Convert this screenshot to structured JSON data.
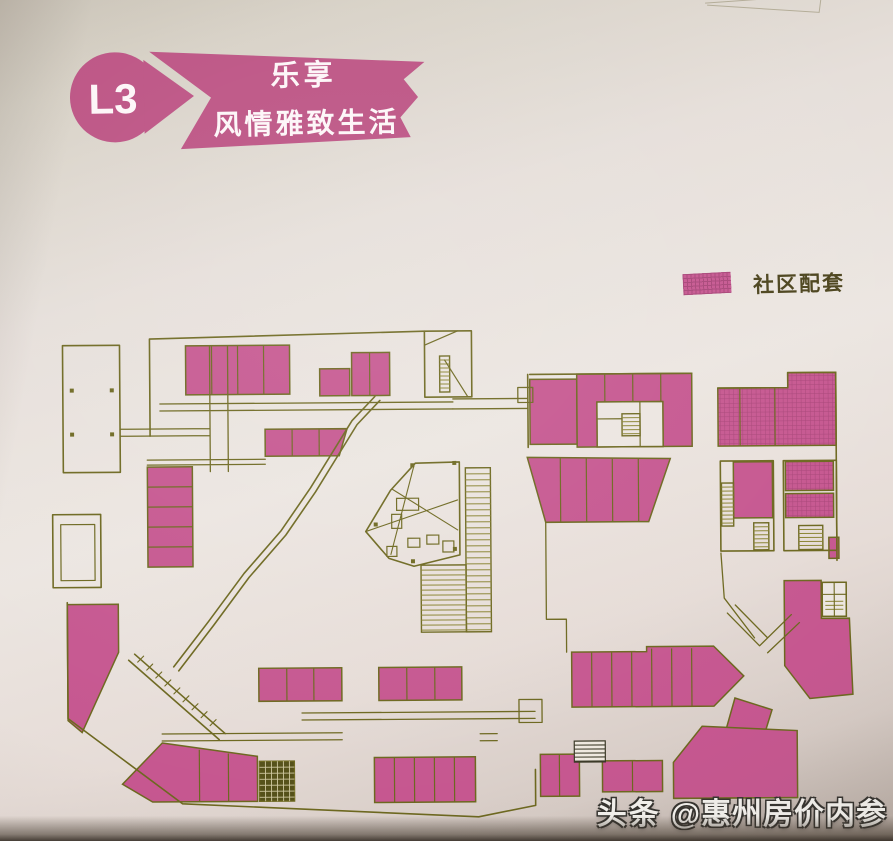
{
  "banner": {
    "level": "L3",
    "tagline_top": "乐享",
    "tagline_bottom": "风情雅致生活"
  },
  "legend": {
    "label": "社区配套"
  },
  "watermark": {
    "brand": "头条",
    "handle": "@惠州房价内参"
  },
  "colors": {
    "banner_pink": "#bc5283",
    "block_pink": "#c65790",
    "block_pink_grid": "#a84578",
    "line_olive": "#6d6820",
    "hatch_olive": "#8a8433",
    "dark_olive": "#55511a",
    "dark_olive_grid": "#cfc8a0",
    "text_olive": "#4b431c",
    "paper": "#ece6e1",
    "stroke_faint": "#b3ac97",
    "watermark_white": "#f3f1ed"
  },
  "floorplan": {
    "paths": [
      {
        "d": "M63,343 H120 V470 H63 Z"
      },
      {
        "d": "M52,512 H100 V585 H52 Z"
      },
      {
        "d": "M60,522 H94 V578 H60 Z",
        "w": 1.2
      },
      {
        "d": "M150,337 L425,331 M150,337 V434"
      },
      {
        "d": "M425,331 H472 V397 H425 Z"
      },
      {
        "d": "M425,345 L458,331 M468,397 L445,360",
        "w": 1.2
      },
      {
        "d": "M210,345 V470 M228,345 V470 M120,427 H210 M120,434 H210 M160,402 H453 M160,409 H453 M147,458 H265 M147,463 H265",
        "w": 1.3
      },
      {
        "d": "M66,600 V716 L180,802 L476,817 L533,806 V770"
      },
      {
        "d": "M160,732 H340 M160,739 H340 M300,712 H533 M300,719 H533",
        "w": 1.3
      },
      {
        "d": "M375,396 L352,420 L310,487 L280,530 L243,572 L207,620 L172,665 M380,400 L357,424 L315,491 L285,534 L248,576 L212,624 L177,669"
      },
      {
        "d": "M127,658 L217,738 M133,652 L223,732"
      },
      {
        "d": "M136,660 L142,654 M145,668 L151,662 M154,676 L160,670 M163,684 L169,678 M172,692 L178,686 M181,700 L187,694 M190,708 L196,702 M199,716 L205,710 M208,724 L214,718",
        "w": 1.1
      },
      {
        "d": "M453,399 H528 M453,409 H528 M518,388 H533 V403 H518 Z",
        "w": 1.3
      },
      {
        "d": "M530,375 H692 M718,390 H788 V375 H836 V563 M528,375 V448"
      },
      {
        "d": "M597,403 H663 V448 H597 Z M597,420 H622 M640,403 V448",
        "w": 1.2
      },
      {
        "d": "M545,523 V578 M545,578 V620 H565 V653",
        "w": 1.3
      },
      {
        "d": "M720,463 H773 V553 H720 Z"
      },
      {
        "d": "M783,463 H836 V553 H783 Z"
      },
      {
        "d": "M726,615 L758,648 M734,607 L766,640 M758,648 L790,617 M766,655 L798,625 M720,555 L723,600 L753,640",
        "w": 1.3
      },
      {
        "d": "M821,585 H845 V619 H821 Z M821,597 H845 M833,585 V619",
        "w": 1.1
      },
      {
        "d": "M671,800 H795 M478,734 H495 M478,741 H495 M517,700 H540 V723 H517 Z",
        "w": 1.3
      },
      {
        "d": "M365,531 L390,490 L415,463 L459,462 L459,555 L413,566 L388,558 Z"
      },
      {
        "d": "M365,531 L457,500 M414,464 L390,554 M392,489 L457,530",
        "w": 1.1
      }
    ],
    "faint_paths": [
      {
        "d": "M708,5 L770,1 M710,7 L822,15 L824,0"
      }
    ],
    "blocks": [
      {
        "type": "plain",
        "rect": [
          186,
          344,
          104,
          49
        ],
        "divs": [
          [
            212,
            344,
            212,
            393
          ],
          [
            238,
            344,
            238,
            393
          ],
          [
            264,
            344,
            264,
            393
          ]
        ]
      },
      {
        "type": "plain",
        "rect": [
          320,
          368,
          30,
          27
        ]
      },
      {
        "type": "plain",
        "rect": [
          352,
          352,
          38,
          43
        ],
        "divs": [
          [
            370,
            352,
            370,
            395
          ]
        ]
      },
      {
        "type": "plain",
        "poly": [
          [
            265,
            428
          ],
          [
            347,
            428
          ],
          [
            339,
            455
          ],
          [
            265,
            455
          ]
        ],
        "divs": [
          [
            292,
            428,
            292,
            455
          ],
          [
            319,
            428,
            319,
            455
          ]
        ]
      },
      {
        "type": "plain",
        "rect": [
          147,
          465,
          45,
          100
        ],
        "divs": [
          [
            147,
            485,
            192,
            485
          ],
          [
            147,
            505,
            192,
            505
          ],
          [
            147,
            525,
            192,
            525
          ],
          [
            147,
            545,
            192,
            545
          ]
        ]
      },
      {
        "type": "plain",
        "poly": [
          [
            66,
            602
          ],
          [
            117,
            602
          ],
          [
            117,
            650
          ],
          [
            80,
            730
          ],
          [
            66,
            718
          ]
        ]
      },
      {
        "type": "plain",
        "poly": [
          [
            160,
            741
          ],
          [
            255,
            755
          ],
          [
            255,
            800
          ],
          [
            150,
            800
          ],
          [
            120,
            782
          ]
        ],
        "divs": [
          [
            197,
            748,
            197,
            800
          ],
          [
            226,
            752,
            226,
            800
          ]
        ]
      },
      {
        "type": "plain",
        "rect": [
          257,
          667,
          83,
          33
        ],
        "divs": [
          [
            285,
            667,
            285,
            700
          ],
          [
            312,
            667,
            312,
            700
          ]
        ]
      },
      {
        "type": "plain",
        "rect": [
          377,
          667,
          83,
          33
        ],
        "divs": [
          [
            405,
            667,
            405,
            700
          ],
          [
            433,
            667,
            433,
            700
          ]
        ]
      },
      {
        "type": "plain",
        "rect": [
          372,
          757,
          101,
          45
        ],
        "divs": [
          [
            392,
            757,
            392,
            802
          ],
          [
            412,
            757,
            412,
            802
          ],
          [
            432,
            757,
            432,
            802
          ],
          [
            452,
            757,
            452,
            802
          ]
        ]
      },
      {
        "type": "plain",
        "rect": [
          538,
          755,
          39,
          42
        ],
        "divs": [
          [
            557,
            755,
            557,
            797
          ]
        ]
      },
      {
        "type": "plain",
        "rect": [
          530,
          380,
          47,
          65
        ]
      },
      {
        "type": "plain",
        "rect": [
          577,
          375,
          115,
          73
        ],
        "divs": [
          [
            605,
            375,
            605,
            403
          ],
          [
            633,
            375,
            633,
            403
          ],
          [
            661,
            375,
            661,
            403
          ]
        ]
      },
      {
        "type": "white",
        "rect": [
          597,
          403,
          66,
          45
        ]
      },
      {
        "type": "grid",
        "poly": [
          [
            718,
            390
          ],
          [
            788,
            390
          ],
          [
            788,
            375
          ],
          [
            836,
            375
          ],
          [
            836,
            448
          ],
          [
            718,
            448
          ]
        ],
        "divs": [
          [
            740,
            390,
            740,
            448
          ],
          [
            775,
            390,
            775,
            448
          ]
        ]
      },
      {
        "type": "plain",
        "poly": [
          [
            527,
            458
          ],
          [
            670,
            460
          ],
          [
            648,
            523
          ],
          [
            545,
            523
          ]
        ],
        "divs": [
          [
            560,
            459,
            560,
            523
          ],
          [
            586,
            459,
            586,
            523
          ],
          [
            612,
            460,
            612,
            523
          ],
          [
            638,
            460,
            638,
            523
          ]
        ]
      },
      {
        "type": "plain",
        "rect": [
          733,
          464,
          39,
          56
        ]
      },
      {
        "type": "grid",
        "rect": [
          785,
          464,
          48,
          29
        ]
      },
      {
        "type": "grid",
        "rect": [
          785,
          496,
          48,
          24
        ]
      },
      {
        "type": "plain",
        "poly": [
          [
            783,
            583
          ],
          [
            820,
            583
          ],
          [
            820,
            621
          ],
          [
            848,
            621
          ],
          [
            851,
            697
          ],
          [
            808,
            701
          ],
          [
            783,
            668
          ]
        ]
      },
      {
        "type": "white",
        "rect": [
          821,
          585,
          24,
          34
        ]
      },
      {
        "type": "plain",
        "poly": [
          [
            570,
            653
          ],
          [
            645,
            653
          ],
          [
            645,
            648
          ],
          [
            712,
            648
          ],
          [
            742,
            678
          ],
          [
            712,
            708
          ],
          [
            570,
            708
          ]
        ],
        "divs": [
          [
            590,
            653,
            590,
            708
          ],
          [
            610,
            653,
            610,
            708
          ],
          [
            630,
            653,
            630,
            708
          ],
          [
            650,
            650,
            650,
            708
          ],
          [
            670,
            650,
            670,
            708
          ],
          [
            690,
            650,
            690,
            708
          ]
        ]
      },
      {
        "type": "plain",
        "poly": [
          [
            733,
            700
          ],
          [
            770,
            712
          ],
          [
            758,
            750
          ],
          [
            722,
            738
          ]
        ]
      },
      {
        "type": "plain",
        "poly": [
          [
            700,
            728
          ],
          [
            795,
            733
          ],
          [
            795,
            800
          ],
          [
            671,
            800
          ],
          [
            671,
            764
          ]
        ]
      },
      {
        "type": "plain",
        "rect": [
          600,
          762,
          60,
          31
        ],
        "divs": [
          [
            630,
            762,
            630,
            793
          ]
        ]
      },
      {
        "type": "plain",
        "rect": [
          828,
          540,
          10,
          21
        ]
      }
    ],
    "hatches": [
      {
        "rect": [
          465,
          468,
          25,
          164
        ],
        "dir": "h",
        "step": 6,
        "outline": true
      },
      {
        "rect": [
          420,
          565,
          45,
          67
        ],
        "dir": "h",
        "step": 5,
        "outline": true
      },
      {
        "rect": [
          440,
          356,
          10,
          36
        ],
        "dir": "h",
        "step": 4,
        "outline": true
      },
      {
        "rect": [
          622,
          415,
          18,
          22
        ],
        "dir": "h",
        "step": 4,
        "outline": true
      },
      {
        "rect": [
          721,
          485,
          12,
          43
        ],
        "dir": "h",
        "step": 4,
        "outline": true
      },
      {
        "rect": [
          753,
          525,
          15,
          27
        ],
        "dir": "h",
        "step": 4,
        "outline": true
      },
      {
        "rect": [
          798,
          528,
          24,
          24
        ],
        "dir": "h",
        "step": 4,
        "outline": true
      },
      {
        "rect": [
          824,
          600,
          18,
          16
        ],
        "dir": "h",
        "step": 4,
        "outline": false
      },
      {
        "rect": [
          257,
          760,
          35,
          40
        ],
        "type": "dark"
      },
      {
        "rect": [
          572,
          742,
          31,
          21
        ],
        "type": "piano"
      }
    ],
    "furniture": [
      [
        396,
        498,
        22,
        12
      ],
      [
        391,
        514,
        10,
        14
      ],
      [
        407,
        538,
        12,
        9
      ],
      [
        426,
        535,
        12,
        9
      ],
      [
        442,
        541,
        11,
        11
      ],
      [
        386,
        546,
        10,
        10
      ]
    ],
    "dots": [
      [
        375,
        524
      ],
      [
        412,
        465
      ],
      [
        454,
        463
      ],
      [
        454,
        549
      ],
      [
        412,
        561
      ],
      [
        72,
        388
      ],
      [
        112,
        388
      ],
      [
        72,
        432
      ],
      [
        112,
        432
      ]
    ]
  }
}
